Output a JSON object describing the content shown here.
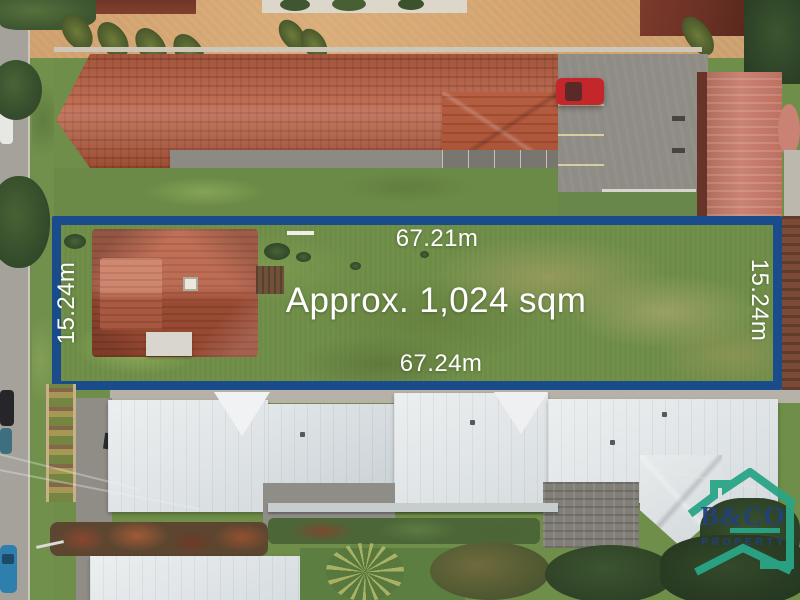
{
  "annotations": {
    "area_label": "Approx. 1,024 sqm",
    "top_length": "67.21m",
    "bottom_length": "67.24m",
    "left_width": "15.24m",
    "right_width": "15.24m"
  },
  "watermark": {
    "brand": "B&CO",
    "tagline": "PROPERTY"
  },
  "colors": {
    "boundary_blue": "#1a4c8c",
    "label_text": "#ffffff",
    "logo_teal": "#2aa587",
    "logo_navy": "#24407e",
    "roof_terracotta": "#b45a3e",
    "roof_white": "#dfe3e5",
    "red_car": "#c3272b",
    "grass_green": "#6d8c46"
  }
}
